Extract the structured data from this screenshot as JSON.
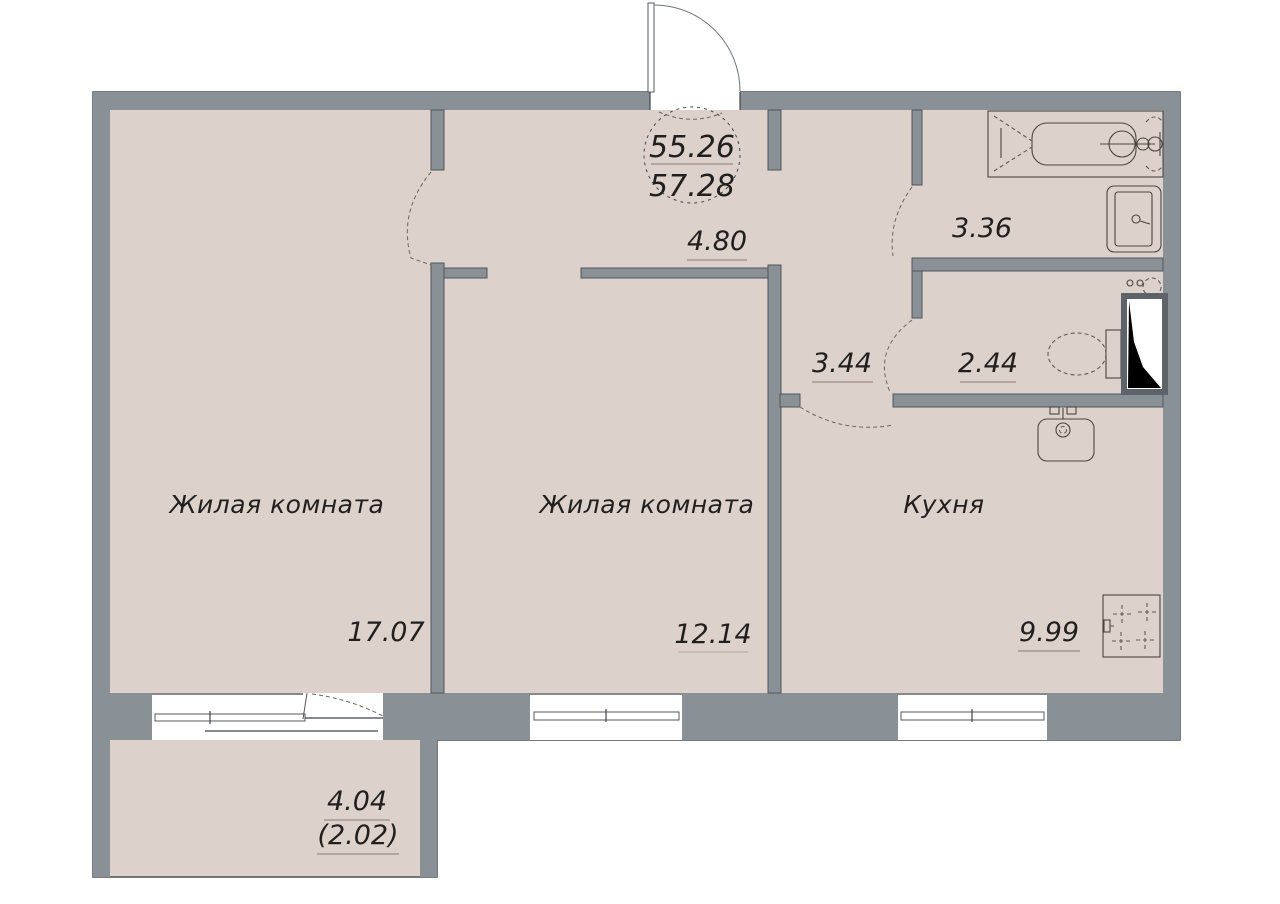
{
  "badge": {
    "total_area": "55.26",
    "total_area_alt": "57.28"
  },
  "rooms": [
    {
      "id": "living-room-1",
      "name": "Жилая комната",
      "area": "17.07"
    },
    {
      "id": "living-room-2",
      "name": "Жилая комната",
      "area": "12.14"
    },
    {
      "id": "kitchen",
      "name": "Кухня",
      "area": "9.99"
    },
    {
      "id": "corridor",
      "name": "",
      "area": "4.80"
    },
    {
      "id": "hallway",
      "name": "",
      "area": "3.44"
    },
    {
      "id": "bathroom",
      "name": "",
      "area": "3.36"
    },
    {
      "id": "toilet",
      "name": "",
      "area": "2.44"
    },
    {
      "id": "balcony",
      "name": "",
      "area": "4.04",
      "area_reduced": "(2.02)"
    }
  ],
  "fixtures": [
    "bathtub-icon",
    "bathroom-sink-icon",
    "toilet-icon",
    "vent-shaft-icon",
    "water-heater-icon",
    "kitchen-sink-icon",
    "stove-icon",
    "entrance-door-icon",
    "window-icon",
    "balcony-door-icon"
  ],
  "colors": {
    "wall": "#8a9196",
    "floor": "#ddd2cb",
    "outline": "#3f4449",
    "text": "#211f1e",
    "underline": "#9b8c82",
    "shaft_fill": "#000000",
    "background": "#ffffff"
  }
}
